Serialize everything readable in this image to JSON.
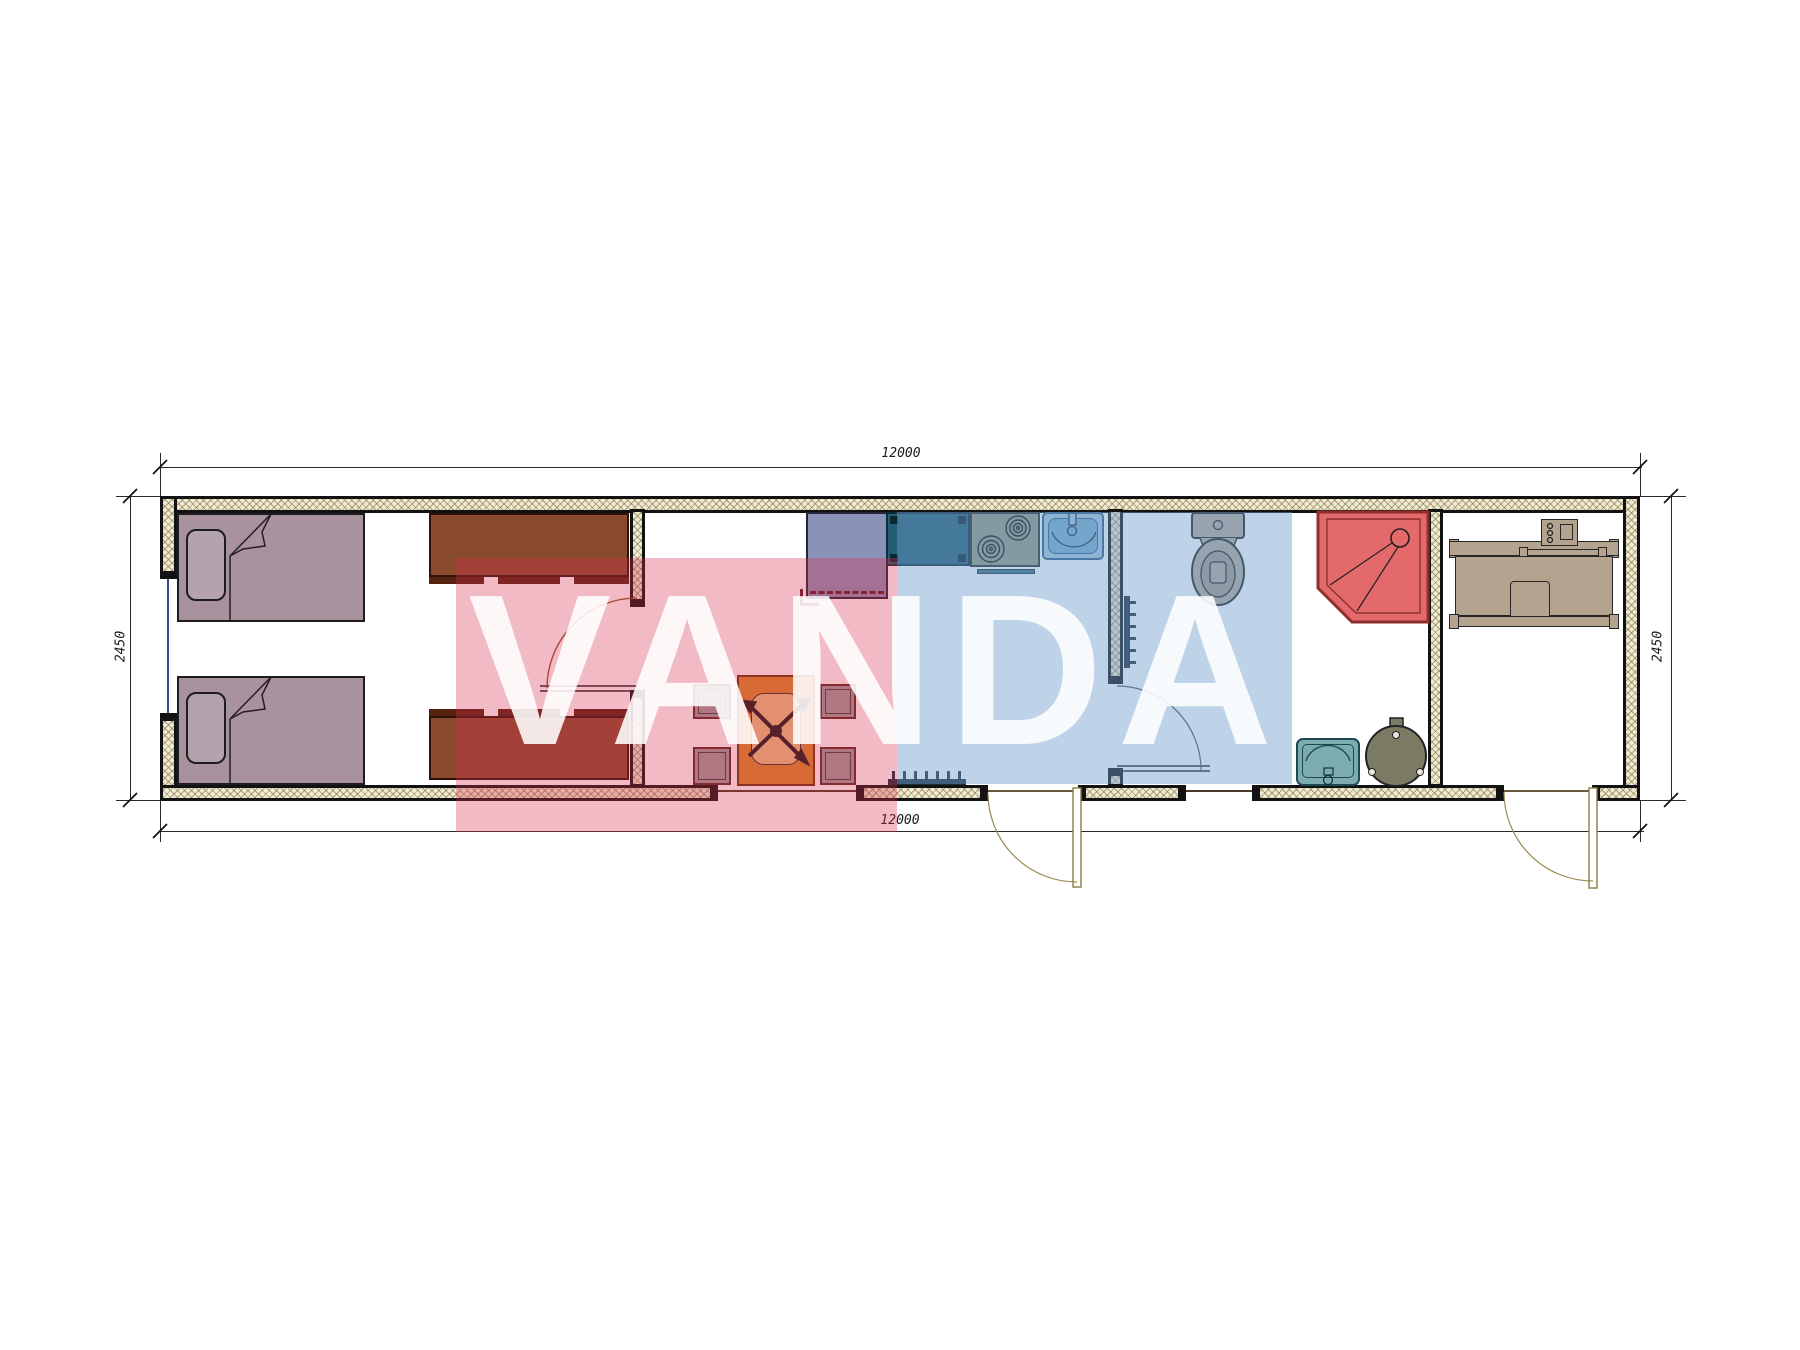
{
  "dimensions": {
    "width_top": "12000",
    "width_bottom": "12000",
    "height_left": "2450",
    "height_right": "2450"
  },
  "watermark": {
    "text": "VANDA",
    "red_block_color": "#d72d4b",
    "blue_block_color": "#6e9bcd"
  },
  "colors": {
    "wall_hatch_fill": "#f0ead2",
    "bed": "#a8929e",
    "cabinet": "#8a4a2e",
    "wardrobe": "#8b92b8",
    "kitchen_counter": "#235d76",
    "stove": "#929c7e",
    "kitchen_sink": "#79aec9",
    "toilet": "#b9ab9a",
    "shower": "#e4696a",
    "washbasin": "#7cacb0",
    "water_heater": "#7b7b63",
    "office_desk": "#b3a38f",
    "dining_table": "#d9882c",
    "chair": "#9c9c9c"
  }
}
